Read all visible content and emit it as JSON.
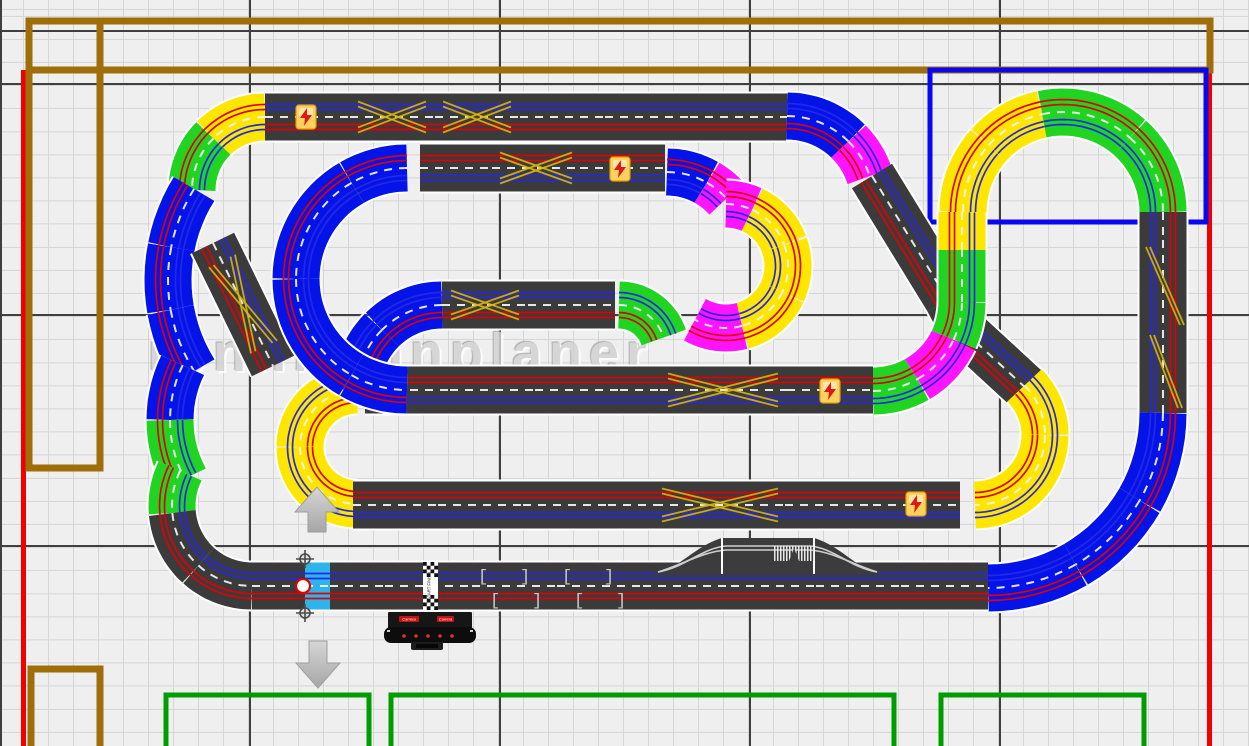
{
  "watermark": {
    "text": "rennbahnplaner"
  },
  "labels": {
    "start_finish": "START FINISH",
    "brand": "Carrera"
  },
  "room": {
    "outlines": [
      {
        "name": "wall-line-red-left",
        "x": 21,
        "y": 70,
        "w": 5,
        "h": 676,
        "fill": "#f20000"
      },
      {
        "name": "wall-line-red-right",
        "x": 1207,
        "y": 70,
        "w": 5,
        "h": 676,
        "fill": "#f20000"
      },
      {
        "name": "furniture-outline-brown-top-band",
        "x": 29,
        "y": 21,
        "w": 1181,
        "h": 49,
        "stroke": "#a06e08",
        "sw": 7
      },
      {
        "name": "furniture-outline-brown-left-tall",
        "x": 29,
        "y": 21,
        "w": 71,
        "h": 447,
        "stroke": "#a06e08",
        "sw": 7
      },
      {
        "name": "furniture-outline-brown-bottom-left",
        "x": 31,
        "y": 669,
        "w": 69,
        "h": 95,
        "stroke": "#a06e08",
        "sw": 7
      },
      {
        "name": "area-outline-blue-top-right",
        "x": 930,
        "y": 70,
        "w": 276,
        "h": 152,
        "stroke": "#0808f0",
        "sw": 5
      },
      {
        "name": "table-outline-green-1",
        "x": 166,
        "y": 695,
        "w": 203,
        "h": 70,
        "stroke": "#009c00",
        "sw": 5
      },
      {
        "name": "table-outline-green-2",
        "x": 391,
        "y": 695,
        "w": 503,
        "h": 70,
        "stroke": "#009c00",
        "sw": 5
      },
      {
        "name": "table-outline-green-3",
        "x": 941,
        "y": 695,
        "w": 203,
        "h": 70,
        "stroke": "#009c00",
        "sw": 5
      }
    ]
  },
  "track": {
    "piece_width": 48,
    "palette": {
      "dark": "#3b3b3b",
      "yellow": "#ffe600",
      "green": "#21d421",
      "blue": "#0414e8",
      "magenta": "#ff14ff",
      "cyan": "#2fb4ea"
    },
    "lane_colors": {
      "center": "#f0f0f0",
      "red": "#e00000",
      "blue": "#2428e6",
      "seam": "#ffffff",
      "lanechange": "#d9b50e"
    },
    "segments": [
      {
        "k": "a",
        "c": "yellow",
        "cc": [
          265,
          190
        ],
        "r": 73,
        "a": [
          270,
          225
        ],
        "f": 1
      },
      {
        "k": "a",
        "c": "green",
        "cc": [
          265,
          190
        ],
        "r": 73,
        "a": [
          225,
          180
        ],
        "f": 1
      },
      {
        "k": "a",
        "c": "blue",
        "cc": [
          340,
          280
        ],
        "r": 172,
        "a": [
          212,
          191
        ],
        "f": 1
      },
      {
        "k": "a",
        "c": "blue",
        "cc": [
          340,
          280
        ],
        "r": 172,
        "a": [
          191,
          170
        ],
        "f": 1
      },
      {
        "k": "a",
        "c": "blue",
        "cc": [
          340,
          280
        ],
        "r": 172,
        "a": [
          170,
          148
        ],
        "f": 1
      },
      {
        "k": "a",
        "c": "blue",
        "cc": [
          295,
          420
        ],
        "r": 125,
        "a": [
          206,
          180
        ],
        "f": 1
      },
      {
        "k": "a",
        "c": "green",
        "cc": [
          295,
          420
        ],
        "r": 125,
        "a": [
          180,
          152
        ],
        "f": 1
      },
      {
        "k": "a",
        "c": "green",
        "cc": [
          252,
          506
        ],
        "r": 80,
        "a": [
          206,
          175
        ],
        "f": 1
      },
      {
        "k": "a",
        "c": "dark",
        "cc": [
          252,
          506
        ],
        "r": 80,
        "a": [
          175,
          132
        ],
        "f": 1
      },
      {
        "k": "a",
        "c": "dark",
        "cc": [
          252,
          506
        ],
        "r": 80,
        "a": [
          132,
          90
        ],
        "f": 1
      },
      {
        "k": "s",
        "c": "dark",
        "p": [
          213,
          243,
          273,
          366
        ],
        "f": 1
      },
      {
        "k": "s",
        "c": "dark",
        "p": [
          265,
          117,
          350,
          117
        ],
        "f": 1
      },
      {
        "k": "s",
        "c": "dark",
        "p": [
          350,
          117,
          435,
          117
        ],
        "f": 1
      },
      {
        "k": "s",
        "c": "dark",
        "p": [
          435,
          117,
          520,
          117
        ],
        "f": 1
      },
      {
        "k": "s",
        "c": "dark",
        "p": [
          520,
          117,
          605,
          117
        ],
        "f": 1
      },
      {
        "k": "s",
        "c": "dark",
        "p": [
          605,
          117,
          690,
          117
        ],
        "f": 1
      },
      {
        "k": "s",
        "c": "dark",
        "p": [
          690,
          117,
          790,
          117
        ],
        "f": 1
      },
      {
        "k": "a",
        "c": "blue",
        "cc": [
          787,
          203
        ],
        "r": 87,
        "a": [
          270,
          315
        ],
        "f": -1
      },
      {
        "k": "a",
        "c": "magenta",
        "cc": [
          787,
          203
        ],
        "r": 87,
        "a": [
          315,
          342
        ],
        "f": -1
      },
      {
        "k": "s",
        "c": "dark",
        "p": [
          872,
          176,
          948,
          300
        ],
        "f": 1
      },
      {
        "k": "s",
        "c": "dark",
        "p": [
          948,
          300,
          965,
          332
        ],
        "f": 1
      },
      {
        "k": "s",
        "c": "dark",
        "p": [
          965,
          332,
          1028,
          390
        ],
        "f": 1
      },
      {
        "k": "a",
        "c": "green",
        "cc": [
          873,
          302
        ],
        "r": 89,
        "a": [
          90,
          60
        ],
        "f": -1
      },
      {
        "k": "a",
        "c": "magenta",
        "cc": [
          873,
          302
        ],
        "r": 89,
        "a": [
          60,
          25
        ],
        "f": -1
      },
      {
        "k": "a",
        "c": "green",
        "cc": [
          873,
          302
        ],
        "r": 89,
        "a": [
          25,
          0
        ],
        "f": -1
      },
      {
        "k": "s",
        "c": "green",
        "p": [
          962,
          302,
          962,
          250
        ],
        "f": -1
      },
      {
        "k": "s",
        "c": "yellow",
        "p": [
          962,
          250,
          962,
          212
        ],
        "f": -1
      },
      {
        "k": "a",
        "c": "yellow",
        "cc": [
          1063,
          212
        ],
        "r": 100,
        "a": [
          180,
          222
        ],
        "f": 1
      },
      {
        "k": "a",
        "c": "yellow",
        "cc": [
          1063,
          212
        ],
        "r": 100,
        "a": [
          222,
          258
        ],
        "f": 1
      },
      {
        "k": "a",
        "c": "green",
        "cc": [
          1063,
          212
        ],
        "r": 100,
        "a": [
          258,
          312
        ],
        "f": 1
      },
      {
        "k": "a",
        "c": "green",
        "cc": [
          1063,
          212
        ],
        "r": 100,
        "a": [
          312,
          360
        ],
        "f": 1
      },
      {
        "k": "s",
        "c": "dark",
        "p": [
          1163,
          212,
          1163,
          240
        ],
        "f": -1
      },
      {
        "k": "s",
        "c": "dark",
        "p": [
          1163,
          240,
          1163,
          330
        ],
        "f": -1
      },
      {
        "k": "s",
        "c": "dark",
        "p": [
          1163,
          330,
          1163,
          413
        ],
        "f": -1
      },
      {
        "k": "a",
        "c": "blue",
        "cc": [
          988,
          413
        ],
        "r": 175,
        "a": [
          0,
          30
        ],
        "f": 1
      },
      {
        "k": "a",
        "c": "blue",
        "cc": [
          988,
          413
        ],
        "r": 175,
        "a": [
          30,
          60
        ],
        "f": 1
      },
      {
        "k": "a",
        "c": "blue",
        "cc": [
          988,
          413
        ],
        "r": 175,
        "a": [
          60,
          90
        ],
        "f": 1
      },
      {
        "k": "a",
        "c": "yellow",
        "cc": [
          975,
          435
        ],
        "r": 70,
        "a": [
          315,
          360
        ],
        "f": -1
      },
      {
        "k": "a",
        "c": "yellow",
        "cc": [
          975,
          435
        ],
        "r": 70,
        "a": [
          360,
          450
        ],
        "f": -1
      },
      {
        "k": "a",
        "c": "blue",
        "cc": [
          667,
          252
        ],
        "r": 80,
        "a": [
          270,
          300
        ],
        "f": 1
      },
      {
        "k": "a",
        "c": "magenta",
        "cc": [
          667,
          252
        ],
        "r": 80,
        "a": [
          300,
          318
        ],
        "f": 1
      },
      {
        "k": "a",
        "c": "magenta",
        "cc": [
          726,
          266
        ],
        "r": 62,
        "a": [
          270,
          295
        ],
        "f": 1
      },
      {
        "k": "a",
        "c": "yellow",
        "cc": [
          726,
          266
        ],
        "r": 62,
        "a": [
          295,
          340
        ],
        "f": 1
      },
      {
        "k": "a",
        "c": "yellow",
        "cc": [
          726,
          266
        ],
        "r": 62,
        "a": [
          340,
          385
        ],
        "f": 1
      },
      {
        "k": "a",
        "c": "yellow",
        "cc": [
          726,
          266
        ],
        "r": 62,
        "a": [
          385,
          435
        ],
        "f": 1
      },
      {
        "k": "a",
        "c": "magenta",
        "cc": [
          726,
          266
        ],
        "r": 62,
        "a": [
          435,
          480
        ],
        "f": 1
      },
      {
        "k": "a",
        "c": "green",
        "cc": [
          619,
          352
        ],
        "r": 47,
        "a": [
          270,
          342
        ],
        "f": -1
      },
      {
        "k": "s",
        "c": "dark",
        "p": [
          442,
          305,
          528,
          305
        ],
        "f": 1
      },
      {
        "k": "s",
        "c": "dark",
        "p": [
          528,
          305,
          615,
          305
        ],
        "f": 1
      },
      {
        "k": "s",
        "c": "dark",
        "p": [
          420,
          168,
          492,
          168
        ],
        "f": -1
      },
      {
        "k": "s",
        "c": "dark",
        "p": [
          492,
          168,
          580,
          168
        ],
        "f": -1
      },
      {
        "k": "s",
        "c": "dark",
        "p": [
          580,
          168,
          665,
          168
        ],
        "f": -1
      },
      {
        "k": "a",
        "c": "yellow",
        "cc": [
          357,
          447
        ],
        "r": 57,
        "a": [
          270,
          180
        ],
        "f": -1
      },
      {
        "k": "a",
        "c": "yellow",
        "cc": [
          357,
          447
        ],
        "r": 57,
        "a": [
          180,
          90
        ],
        "f": -1
      },
      {
        "k": "a",
        "c": "blue",
        "cc": [
          442,
          390
        ],
        "r": 85,
        "a": [
          270,
          225
        ],
        "f": -1
      },
      {
        "k": "a",
        "c": "blue",
        "cc": [
          442,
          390
        ],
        "r": 85,
        "a": [
          225,
          180
        ],
        "f": -1
      },
      {
        "k": "s",
        "c": "dark",
        "p": [
          365,
          390,
          450,
          390
        ],
        "f": -1
      },
      {
        "k": "s",
        "c": "dark",
        "p": [
          450,
          390,
          535,
          390
        ],
        "f": -1
      },
      {
        "k": "s",
        "c": "dark",
        "p": [
          535,
          390,
          620,
          390
        ],
        "f": -1
      },
      {
        "k": "s",
        "c": "dark",
        "p": [
          620,
          390,
          660,
          390
        ],
        "f": -1
      },
      {
        "k": "s",
        "c": "dark",
        "p": [
          660,
          390,
          787,
          390
        ],
        "f": -1
      },
      {
        "k": "s",
        "c": "dark",
        "p": [
          787,
          390,
          873,
          390
        ],
        "f": -1
      },
      {
        "k": "a",
        "c": "blue",
        "cc": [
          407,
          279
        ],
        "r": 111,
        "a": [
          270,
          240
        ],
        "f": 1
      },
      {
        "k": "a",
        "c": "blue",
        "cc": [
          407,
          279
        ],
        "r": 111,
        "a": [
          240,
          180
        ],
        "f": 1
      },
      {
        "k": "a",
        "c": "blue",
        "cc": [
          407,
          279
        ],
        "r": 111,
        "a": [
          180,
          120
        ],
        "f": 1
      },
      {
        "k": "a",
        "c": "blue",
        "cc": [
          407,
          279
        ],
        "r": 111,
        "a": [
          120,
          90
        ],
        "f": 1
      },
      {
        "k": "s",
        "c": "dark",
        "p": [
          353,
          505,
          438,
          505
        ],
        "f": -1
      },
      {
        "k": "s",
        "c": "dark",
        "p": [
          438,
          505,
          523,
          505
        ],
        "f": -1
      },
      {
        "k": "s",
        "c": "dark",
        "p": [
          523,
          505,
          608,
          505
        ],
        "f": -1
      },
      {
        "k": "s",
        "c": "dark",
        "p": [
          608,
          505,
          655,
          505
        ],
        "f": -1
      },
      {
        "k": "s",
        "c": "dark",
        "p": [
          655,
          505,
          785,
          505
        ],
        "f": -1
      },
      {
        "k": "s",
        "c": "dark",
        "p": [
          785,
          505,
          873,
          505
        ],
        "f": -1
      },
      {
        "k": "s",
        "c": "dark",
        "p": [
          873,
          505,
          960,
          505
        ],
        "f": -1
      },
      {
        "k": "s",
        "c": "dark",
        "p": [
          252,
          586,
          305,
          586
        ],
        "f": 1
      },
      {
        "k": "s",
        "c": "cyan",
        "p": [
          305,
          586,
          330,
          586
        ],
        "f": 1,
        "sel": true
      },
      {
        "k": "s",
        "c": "dark",
        "p": [
          330,
          586,
          385,
          586
        ],
        "f": 1
      },
      {
        "k": "s",
        "c": "dark",
        "p": [
          385,
          586,
          472,
          586
        ],
        "f": 1
      },
      {
        "k": "s",
        "c": "dark",
        "p": [
          472,
          586,
          557,
          586
        ],
        "f": 1
      },
      {
        "k": "s",
        "c": "dark",
        "p": [
          557,
          586,
          643,
          586
        ],
        "f": 1
      },
      {
        "k": "s",
        "c": "dark",
        "p": [
          643,
          586,
          731,
          586
        ],
        "f": 1
      },
      {
        "k": "s",
        "c": "dark",
        "p": [
          731,
          586,
          816,
          586
        ],
        "f": 1
      },
      {
        "k": "s",
        "c": "dark",
        "p": [
          816,
          586,
          901,
          586
        ],
        "f": 1
      },
      {
        "k": "s",
        "c": "dark",
        "p": [
          901,
          586,
          988,
          586
        ],
        "f": 1
      }
    ],
    "x_marks": [
      {
        "x": 392,
        "y": 117,
        "hw": 34,
        "hh": 13,
        "rot": 0
      },
      {
        "x": 477,
        "y": 117,
        "hw": 34,
        "hh": 13,
        "rot": 0
      },
      {
        "x": 536,
        "y": 168,
        "hw": 36,
        "hh": 13,
        "rot": 0
      },
      {
        "x": 485,
        "y": 305,
        "hw": 34,
        "hh": 12,
        "rot": 0
      },
      {
        "x": 723,
        "y": 390,
        "hw": 55,
        "hh": 14,
        "rot": 0
      },
      {
        "x": 720,
        "y": 505,
        "hw": 58,
        "hh": 14,
        "rot": 0
      },
      {
        "x": 243,
        "y": 304,
        "hw": 48,
        "hh": 12,
        "rot": 64
      }
    ],
    "diag_marks": [
      [
        1146,
        247,
        1180,
        325
      ],
      [
        1150,
        335,
        1178,
        408
      ]
    ],
    "bolts": [
      [
        306,
        117
      ],
      [
        620,
        169
      ],
      [
        830,
        391
      ],
      [
        916,
        504
      ]
    ],
    "brackets": [
      [
        478,
        581,
        "["
      ],
      [
        520,
        581,
        "]"
      ],
      [
        562,
        581,
        "["
      ],
      [
        604,
        581,
        "]"
      ],
      [
        490,
        605,
        "["
      ],
      [
        532,
        605,
        "]"
      ],
      [
        574,
        605,
        "["
      ],
      [
        616,
        605,
        "]"
      ]
    ],
    "start_finish": {
      "band": [
        423,
        438
      ],
      "checker_rows": [
        [
          562,
          577
        ],
        [
          595,
          610
        ]
      ],
      "mid": [
        577,
        595
      ]
    },
    "bridge": {
      "x0": 650,
      "x1": 885,
      "p0": 722,
      "p1": 814,
      "top": 538,
      "base": 574,
      "stripes": [
        774,
        546,
        40,
        15
      ]
    },
    "control_unit": {
      "body": [
        388,
        612,
        84,
        17
      ],
      "chips": [
        [
          399,
          616,
          20,
          6
        ],
        [
          437,
          616,
          17,
          6
        ]
      ],
      "band": [
        384,
        627,
        92,
        16
      ],
      "dots_y": 636,
      "dots_x": [
        404,
        416,
        428,
        440,
        452
      ],
      "tab": [
        411,
        642,
        32,
        8
      ]
    }
  },
  "selection": {
    "handles": [
      [
        305,
        559
      ],
      [
        305,
        613
      ]
    ],
    "center_handle": [
      303,
      586
    ]
  },
  "arrows": {
    "up": "317,487 295,512 308,512 308,532 326,532 326,512 339,512",
    "down": "318,688 296,663 309,663 309,641 327,641 327,663 340,663"
  }
}
